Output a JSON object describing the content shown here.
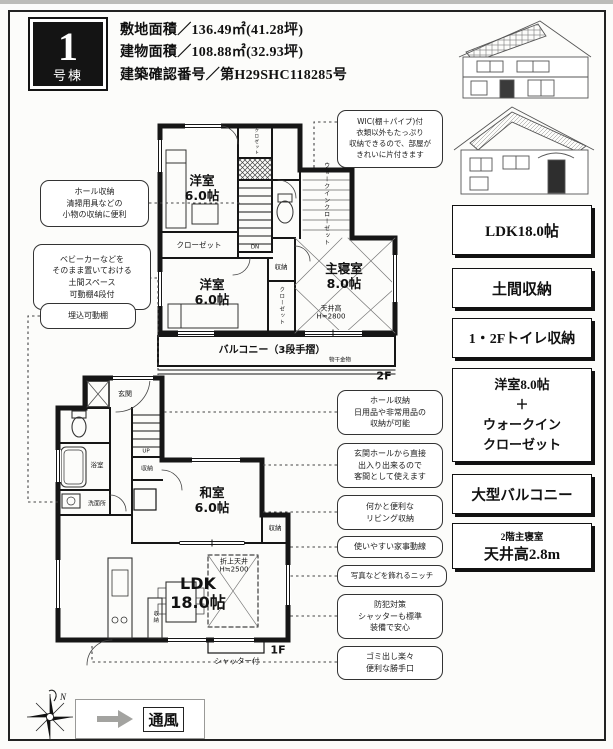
{
  "header": {
    "unit_number": "1",
    "unit_suffix": "号棟",
    "site_area": "敷地面積／136.49㎡(41.28坪)",
    "building_area": "建物面積／108.88㎡(32.93坪)",
    "confirmation_number": "建築確認番号／第H29SHC118285号"
  },
  "features": [
    {
      "lines": [
        "LDK18.0帖"
      ]
    },
    {
      "lines": [
        "土間収納"
      ]
    },
    {
      "lines": [
        "1・2Fトイレ収納"
      ]
    },
    {
      "lines": [
        "洋室8.0帖",
        "＋",
        "ウォークイン",
        "クローゼット"
      ]
    },
    {
      "lines": [
        "大型バルコニー"
      ]
    },
    {
      "lines": [
        "2階主寝室"
      ],
      "sub": "天井高2.8m"
    }
  ],
  "callouts_left": [
    {
      "lines": [
        "ホール収納",
        "清掃用具などの",
        "小物の収納に便利"
      ]
    },
    {
      "lines": [
        "ベビーカーなどを",
        "そのまま置いておける",
        "土間スペース",
        "可動棚4段付"
      ]
    },
    {
      "lines": [
        "埋込可動棚"
      ]
    }
  ],
  "callout_wic": {
    "lines": [
      "WIC(棚＋パイプ)付",
      "衣類以外もたっぷり",
      "収納できるので、部屋が",
      "きれいに片付きます"
    ]
  },
  "callouts_right": [
    {
      "lines": [
        "ホール収納",
        "日用品や非常用品の",
        "収納が可能"
      ]
    },
    {
      "lines": [
        "玄関ホールから直接",
        "出入り出来るので",
        "客間として使えます"
      ]
    },
    {
      "lines": [
        "何かと便利な",
        "リビング収納"
      ]
    },
    {
      "lines": [
        "使いやすい家事動線"
      ]
    },
    {
      "lines": [
        "写真などを飾れるニッチ"
      ]
    },
    {
      "lines": [
        "防犯対策",
        "シャッターも標準",
        "装備で安心"
      ]
    },
    {
      "lines": [
        "ゴミ出し楽々",
        "便利な勝手口"
      ]
    }
  ],
  "plan2f": {
    "floor": "2F",
    "room1": [
      "洋室",
      "6.0帖"
    ],
    "closet1": "クローゼット",
    "closet_top": "クロゼット",
    "dn": "DN",
    "room2": [
      "洋室",
      "6.0帖"
    ],
    "storage": "収納",
    "closet2": "クローゼット",
    "master": [
      "主寝室",
      "8.0帖"
    ],
    "ceiling": [
      "天井高",
      "H=2800"
    ],
    "wic": "ウォークインクローゼット",
    "balcony": "バルコニー（3段手摺）",
    "laundry": "物干金物"
  },
  "plan1f": {
    "floor": "1F",
    "genkan": "玄関",
    "up": "UP",
    "hall_storage": "収納",
    "washitsu": [
      "和室",
      "6.0帖"
    ],
    "storage_r": "収納",
    "ldk": [
      "LDK",
      "18.0帖"
    ],
    "coffered": [
      "折上天井",
      "H≒2500"
    ],
    "living_storage": "収納",
    "bath": "浴室",
    "washroom": "洗面所",
    "shutter": "シャッター付"
  },
  "footer": {
    "wind": "通風",
    "north": "N"
  }
}
